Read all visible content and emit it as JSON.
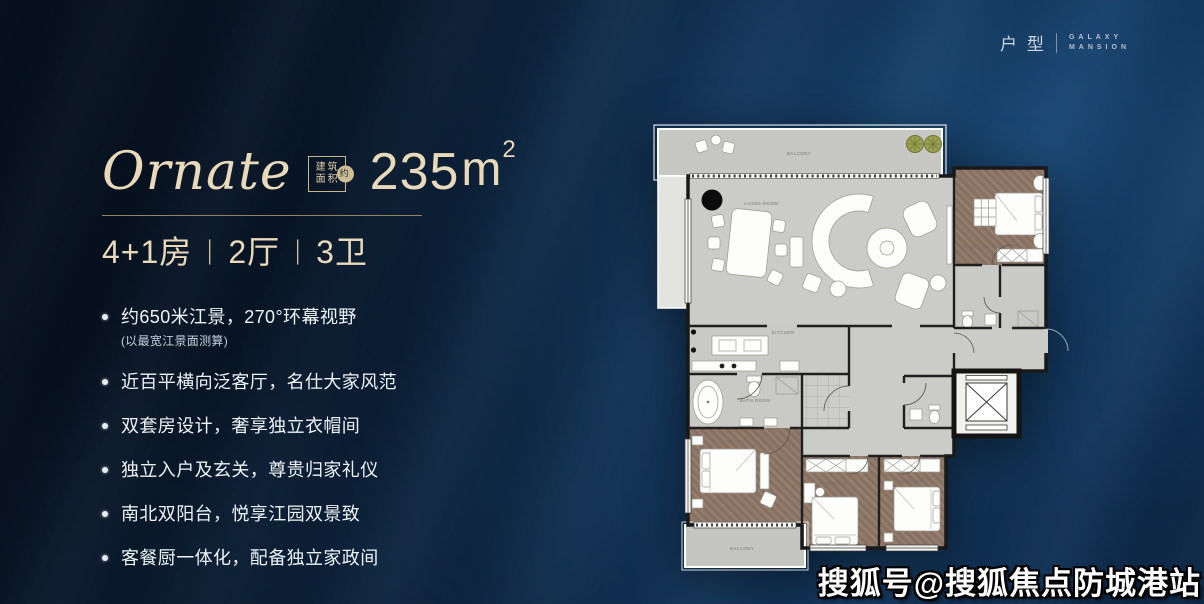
{
  "header": {
    "category_label": "户型",
    "brand_line1": "GALAXY",
    "brand_line2": "MANSION"
  },
  "listing": {
    "title": "Ornate",
    "area_badge": {
      "line1": "建筑",
      "line2": "面积",
      "tag": "约"
    },
    "area": {
      "value": "235",
      "unit": "m",
      "superscript": "2"
    },
    "layout": {
      "rooms": "4+1房",
      "separator": "|",
      "halls": "2厅",
      "baths": "3卫"
    },
    "features": [
      {
        "text": "约650米江景，270°环幕视野",
        "note": "(以最宽江景面测算)"
      },
      {
        "text": "近百平横向泛客厅，名仕大家风范"
      },
      {
        "text": "双套房设计，奢享独立衣帽间"
      },
      {
        "text": "独立入户及玄关，尊贵归家礼仪"
      },
      {
        "text": "南北双阳台，悦享江园双景致"
      },
      {
        "text": "客餐厨一体化，配备独立家政间"
      }
    ]
  },
  "floorplan": {
    "labels": {
      "balcony_top": "BALCONY",
      "living": "LIVING ROOM",
      "kitchen": "KITCHEN",
      "bath": "BATH ROOM",
      "master": "MASTER ROOM",
      "bedroom_left": "BEDROOM",
      "bedroom_mid": "BEDROOM",
      "bedroom_right": "BEDROOM",
      "balcony_bottom": "BALCONY"
    }
  },
  "watermark": {
    "text": "搜狐号@搜狐焦点防城港站"
  },
  "colors": {
    "background_navy": "#0a1c30",
    "wave_blue": "#16436d",
    "accent_beige": "#e9d9bb",
    "text_white": "#eef2f7",
    "wood_brown": "#8d7666",
    "floor_gray": "#c9cac5",
    "plant_green": "#9aa14d"
  }
}
